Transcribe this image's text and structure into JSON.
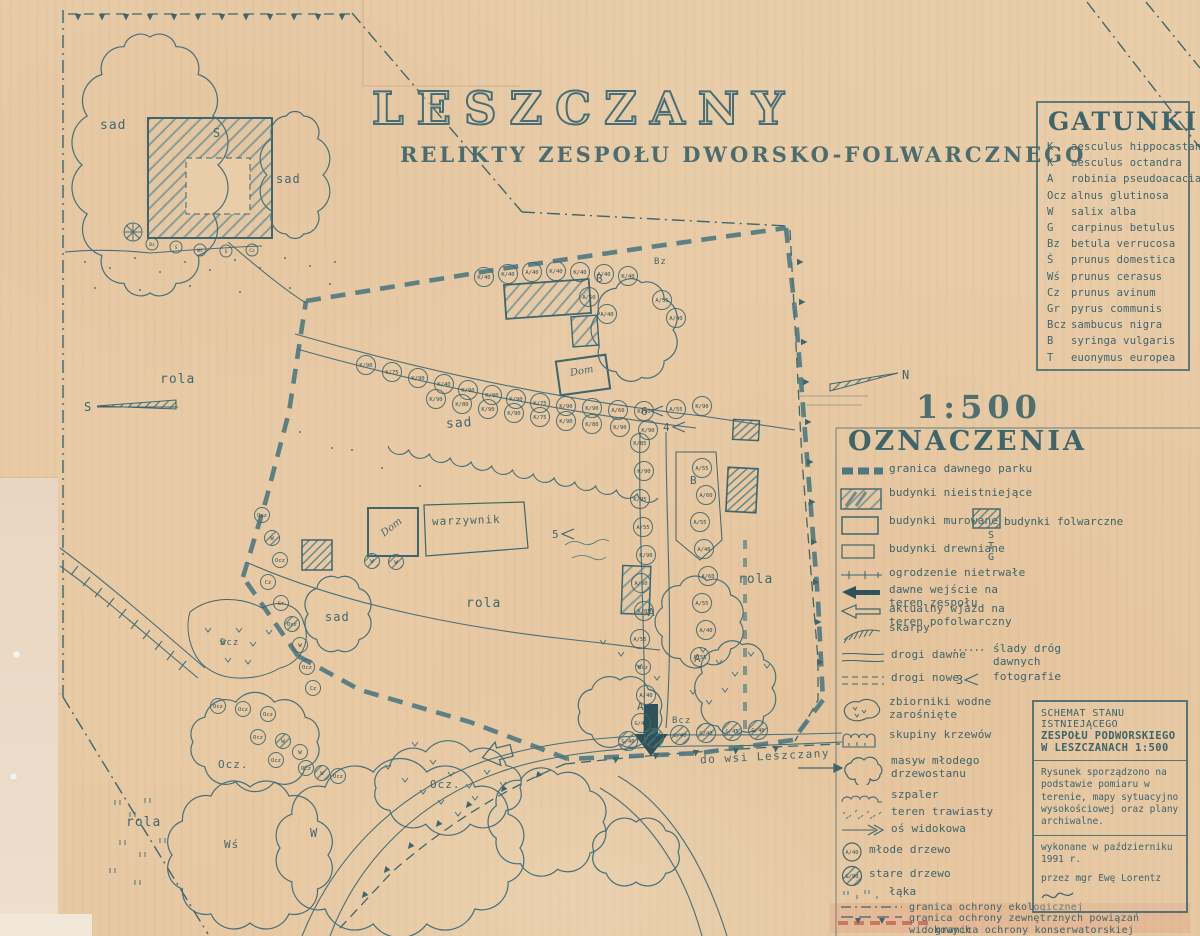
{
  "page": {
    "title": "LESZCZANY",
    "subtitle": "RELIKTY  ZESPOŁU  DWORSKO-FOLWARCZNEGO",
    "scale_label": "1:500",
    "north_label": "N",
    "south_label": "S",
    "road_label": "do wsi Leszczany"
  },
  "gatunki": {
    "title": "GATUNKI",
    "items": [
      {
        "code": "K",
        "name": "aesculus hippocastani"
      },
      {
        "code": "K",
        "name": "aesculus octandra"
      },
      {
        "code": "A",
        "name": "robinia pseudoacacia"
      },
      {
        "code": "Ocz",
        "name": "alnus glutinosa"
      },
      {
        "code": "W",
        "name": "salix alba"
      },
      {
        "code": "G",
        "name": "carpinus betulus"
      },
      {
        "code": "Bz",
        "name": "betula verrucosa"
      },
      {
        "code": "Ś",
        "name": "prunus domestica"
      },
      {
        "code": "Wś",
        "name": "prunus cerasus"
      },
      {
        "code": "Cz",
        "name": "prunus avinum"
      },
      {
        "code": "Gr",
        "name": "pyrus communis"
      },
      {
        "code": "Bcz",
        "name": "sambucus nigra"
      },
      {
        "code": "B",
        "name": "syringa vulgaris"
      },
      {
        "code": "T",
        "name": "euonymus europea"
      }
    ]
  },
  "oznaczenia": {
    "title": "OZNACZENIA",
    "photo_symbol": "3",
    "young_tree_tag": "A/40",
    "old_tree_tag": "G/90",
    "stg": [
      "S",
      "T",
      "G"
    ],
    "items": [
      {
        "label": "granica dawnego parku"
      },
      {
        "label": "budynki nieistniejące"
      },
      {
        "label": "budynki murowane"
      },
      {
        "label": "budynki folwarczne"
      },
      {
        "label": "budynki drewniane"
      },
      {
        "label": "ogrodzenie nietrwałe"
      },
      {
        "label": "dawne wejście na teren zespołu"
      },
      {
        "label": "aktualny wjazd na teren pofolwarczny"
      },
      {
        "label": "skarpy"
      },
      {
        "label": "drogi dawne"
      },
      {
        "label": "drogi nowe"
      },
      {
        "label": "ślady dróg dawnych"
      },
      {
        "label": "fotografie"
      },
      {
        "label": "zbiorniki wodne zarośnięte"
      },
      {
        "label": "skupiny krzewów"
      },
      {
        "label": "masyw młodego drzewostanu"
      },
      {
        "label": "szpaler"
      },
      {
        "label": "teren trawiasty"
      },
      {
        "label": "oś widokowa"
      },
      {
        "label": "młode drzewo"
      },
      {
        "label": "stare drzewo"
      },
      {
        "label": "łąka"
      },
      {
        "label": "granica ochrony ekologicznej"
      },
      {
        "label": "granica ochrony zewnętrznych powiązań widokowych"
      },
      {
        "label": "granica ochrony konserwatorskiej"
      }
    ]
  },
  "schemat": {
    "line1": "SCHEMAT STANU",
    "line2": "ISTNIEJĄCEGO",
    "line3": "ZESPOŁU PODWORSKIEGO",
    "line4": "W LESZCZANACH 1:500",
    "body": "Rysunek sporządzono na podstawie pomiaru w terenie, mapy sytuacyjno wysokościowej oraz plany archiwalne.",
    "made_line1": "wykonane w październiku 1991 r.",
    "made_line2": "przez mgr Ewę Lorentz"
  },
  "map": {
    "labels": [
      {
        "t": "sad",
        "x": 100,
        "y": 118,
        "fs": 13
      },
      {
        "t": "sad",
        "x": 276,
        "y": 172,
        "fs": 12
      },
      {
        "t": "sad",
        "x": 446,
        "y": 416,
        "fs": 13,
        "rot": -4
      },
      {
        "t": "sad",
        "x": 325,
        "y": 610,
        "fs": 12
      },
      {
        "t": "rola",
        "x": 160,
        "y": 372,
        "fs": 13
      },
      {
        "t": "rola",
        "x": 466,
        "y": 596,
        "fs": 13
      },
      {
        "t": "rola",
        "x": 738,
        "y": 572,
        "fs": 13
      },
      {
        "t": "rola",
        "x": 126,
        "y": 815,
        "fs": 13
      },
      {
        "t": "warzywnik",
        "x": 432,
        "y": 514,
        "fs": 11,
        "rot": -2
      },
      {
        "t": "Dom",
        "x": 570,
        "y": 366,
        "fs": 10,
        "cls": "script",
        "rot": -10
      },
      {
        "t": "Dom",
        "x": 380,
        "y": 522,
        "fs": 10,
        "cls": "script",
        "rot": -38
      },
      {
        "t": "S",
        "x": 213,
        "y": 126,
        "fs": 12
      },
      {
        "t": "B",
        "x": 596,
        "y": 272,
        "fs": 11
      },
      {
        "t": "B",
        "x": 690,
        "y": 474,
        "fs": 11
      },
      {
        "t": "A",
        "x": 648,
        "y": 606,
        "fs": 11
      },
      {
        "t": "A",
        "x": 694,
        "y": 652,
        "fs": 11
      },
      {
        "t": "A",
        "x": 637,
        "y": 700,
        "fs": 11
      },
      {
        "t": "Ocz.",
        "x": 218,
        "y": 758,
        "fs": 11
      },
      {
        "t": "Ocz.",
        "x": 430,
        "y": 778,
        "fs": 11
      },
      {
        "t": "W",
        "x": 310,
        "y": 826,
        "fs": 12
      },
      {
        "t": "Wś",
        "x": 224,
        "y": 838,
        "fs": 11
      },
      {
        "t": "Bcz",
        "x": 672,
        "y": 716,
        "fs": 9
      },
      {
        "t": "Bcz",
        "x": 220,
        "y": 638,
        "fs": 9
      },
      {
        "t": "Bz",
        "x": 654,
        "y": 257,
        "fs": 9
      }
    ],
    "trees": [
      [
        "K/40",
        484,
        277
      ],
      [
        "K/40",
        508,
        274
      ],
      [
        "A/40",
        532,
        272
      ],
      [
        "K/40",
        556,
        271
      ],
      [
        "K/40",
        580,
        272
      ],
      [
        "A/40",
        604,
        274
      ],
      [
        "K/40",
        628,
        276
      ],
      [
        "A/55",
        662,
        300
      ],
      [
        "A/40",
        676,
        318
      ],
      [
        "A/50",
        589,
        297
      ],
      [
        "A/40",
        607,
        314
      ],
      [
        "K/90",
        366,
        365
      ],
      [
        "K/75",
        392,
        372
      ],
      [
        "K/90",
        418,
        378
      ],
      [
        "K/40",
        444,
        384
      ],
      [
        "K/90",
        468,
        390
      ],
      [
        "K/80",
        492,
        395
      ],
      [
        "K/90",
        516,
        399
      ],
      [
        "K/75",
        540,
        403
      ],
      [
        "K/90",
        566,
        406
      ],
      [
        "K/90",
        592,
        408
      ],
      [
        "A/60",
        618,
        410
      ],
      [
        "K/90",
        644,
        411
      ],
      [
        "A/55",
        676,
        409
      ],
      [
        "K/90",
        702,
        406
      ],
      [
        "K/90",
        436,
        399
      ],
      [
        "K/80",
        462,
        404
      ],
      [
        "K/90",
        488,
        409
      ],
      [
        "K/90",
        514,
        413
      ],
      [
        "K/75",
        540,
        417
      ],
      [
        "K/90",
        566,
        421
      ],
      [
        "K/80",
        592,
        424
      ],
      [
        "K/90",
        620,
        427
      ],
      [
        "K/90",
        648,
        430
      ],
      [
        "K/85",
        640,
        443
      ],
      [
        "K/90",
        644,
        471
      ],
      [
        "K/95",
        640,
        499
      ],
      [
        "A/55",
        643,
        527
      ],
      [
        "K/90",
        646,
        555
      ],
      [
        "A/60",
        641,
        583
      ],
      [
        "K/85",
        644,
        611
      ],
      [
        "A/55",
        640,
        639
      ],
      [
        "Bcz",
        643,
        667
      ],
      [
        "A/40",
        646,
        695
      ],
      [
        "G/45",
        641,
        723
      ],
      [
        "A/55",
        702,
        468
      ],
      [
        "A/60",
        706,
        495
      ],
      [
        "A/55",
        700,
        522
      ],
      [
        "A/40",
        704,
        549
      ],
      [
        "A/60",
        708,
        576
      ],
      [
        "A/55",
        702,
        603
      ],
      [
        "A/40",
        706,
        630
      ],
      [
        "A/55",
        700,
        657
      ],
      [
        "Ocz",
        262,
        515,
        0
      ],
      [
        "W",
        272,
        538,
        1
      ],
      [
        "Ocz",
        280,
        560,
        0
      ],
      [
        "Cz",
        268,
        582,
        0
      ],
      [
        "Gr",
        281,
        603,
        0
      ],
      [
        "Ocz",
        292,
        624,
        1
      ],
      [
        "W",
        300,
        645,
        0
      ],
      [
        "Ocz",
        307,
        667,
        0
      ],
      [
        "Cz",
        313,
        688,
        0
      ],
      [
        "Ocz",
        218,
        706,
        0
      ],
      [
        "Ocz",
        243,
        709,
        0
      ],
      [
        "Ocz",
        268,
        714,
        0
      ],
      [
        "Ocz",
        258,
        737,
        0
      ],
      [
        "W",
        283,
        741,
        1
      ],
      [
        "Ocz",
        276,
        760,
        0
      ],
      [
        "W",
        300,
        752,
        0
      ],
      [
        "Ocz",
        306,
        768,
        0
      ],
      [
        "W",
        322,
        773,
        1
      ],
      [
        "Ocz",
        338,
        776,
        0
      ],
      [
        "G/40",
        628,
        741,
        1
      ],
      [
        "G/45",
        654,
        738,
        1
      ],
      [
        "G/40",
        680,
        735,
        1
      ],
      [
        "G/40",
        706,
        733,
        1
      ],
      [
        "G/45",
        732,
        731,
        1
      ],
      [
        "G/40",
        758,
        730,
        1
      ],
      [
        "W",
        372,
        561,
        1
      ],
      [
        "W",
        396,
        562,
        1
      ],
      [
        "Bz",
        152,
        244,
        0,
        1
      ],
      [
        "Ś",
        176,
        247,
        0,
        1
      ],
      [
        "Wś",
        200,
        250,
        0,
        1
      ],
      [
        "Ś",
        226,
        251,
        0,
        1
      ],
      [
        "Cz",
        252,
        250,
        0,
        1
      ]
    ],
    "photo_marks": [
      {
        "n": "5",
        "x": 552,
        "y": 534
      },
      {
        "n": "6",
        "x": 641,
        "y": 411
      },
      {
        "n": "4",
        "x": 663,
        "y": 427
      }
    ]
  }
}
